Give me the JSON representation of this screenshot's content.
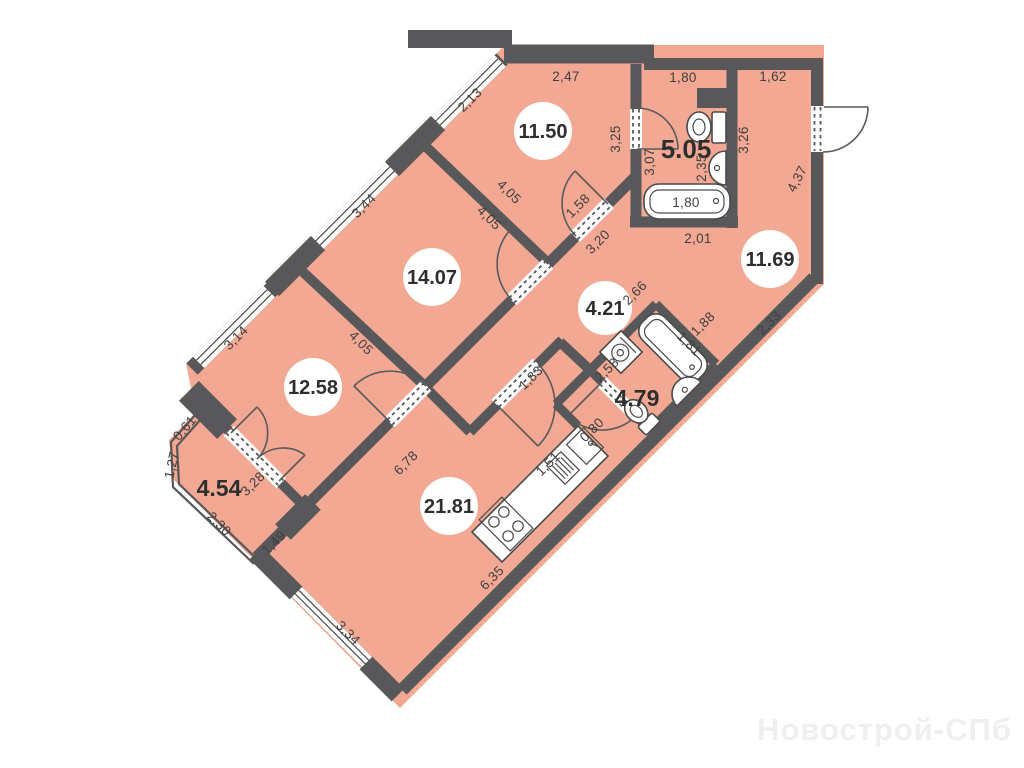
{
  "plan": {
    "title": "apartment-floor-plan",
    "watermark": "Новострой-СПб",
    "areas": {
      "r1150": "11.50",
      "r1407": "14.07",
      "r1258": "12.58",
      "r2181": "21.81",
      "r421": "4.21",
      "r1169": "11.69",
      "r505": "5.05",
      "r454": "4.54",
      "r479": "4.79"
    },
    "dims": {
      "d247": "2,47",
      "d180top": "1,80",
      "d162": "1,62",
      "d213": "2,13",
      "d344": "3,44",
      "d314": "3,14",
      "d405a": "4,05",
      "d405b": "4,05",
      "d405c": "4,05",
      "d325": "3,25",
      "d307": "3,07",
      "d235": "2,35",
      "d326": "3,26",
      "d437": "4,37",
      "d180tub": "1,80",
      "d201": "2,01",
      "d158": "1,58",
      "d320": "3,20",
      "d266": "2,66",
      "d188": "1,88",
      "d233": "2,33",
      "d181": "1,81",
      "d258": "2,58",
      "d183": "1,83",
      "d080": "0,80",
      "d151": "1,51",
      "d678": "6,78",
      "d635": "6,35",
      "d334": "3,34",
      "d149": "1,49",
      "d230": "2,30",
      "d328": "3,28",
      "d127": "1,27",
      "d061": "0,61"
    },
    "colors": {
      "floor": "#f2a892",
      "wall": "#58585a",
      "dim_text": "#3f3f3f",
      "area_text": "#2e2e2e",
      "watermark": "#efefef",
      "background": "#ffffff"
    }
  }
}
